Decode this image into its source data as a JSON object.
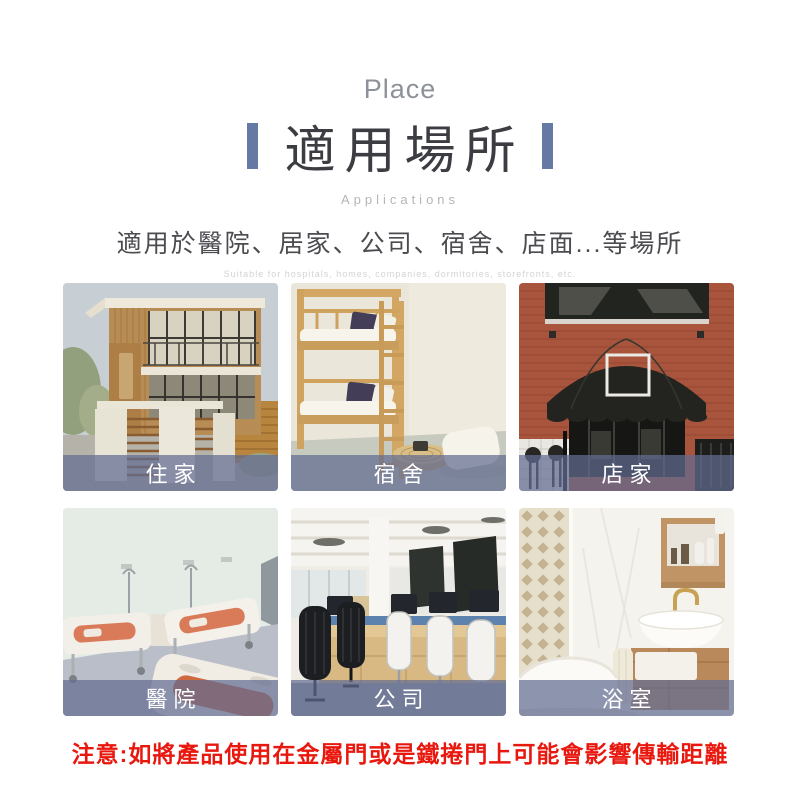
{
  "header": {
    "eyebrow": "Place",
    "title": "適用場所",
    "caption": "Applications"
  },
  "intro": {
    "text": "適用於醫院、居家、公司、宿舍、店面...等場所",
    "text_en": "Suitable for hospitals, homes, companies, dormitories, storefronts, etc."
  },
  "gallery": {
    "items": [
      {
        "name": "home",
        "label": "住家"
      },
      {
        "name": "dormitory",
        "label": "宿舍"
      },
      {
        "name": "store",
        "label": "店家"
      },
      {
        "name": "hospital",
        "label": "醫院"
      },
      {
        "name": "office",
        "label": "公司"
      },
      {
        "name": "bathroom",
        "label": "浴室"
      }
    ]
  },
  "notice": {
    "text": "注意:如將產品使用在金屬門或是鐵捲門上可能會影響傳輸距離"
  },
  "colors": {
    "accent_bar": "#6679a4",
    "label_overlay": "#626c92",
    "notice_red": "#e8180f"
  }
}
